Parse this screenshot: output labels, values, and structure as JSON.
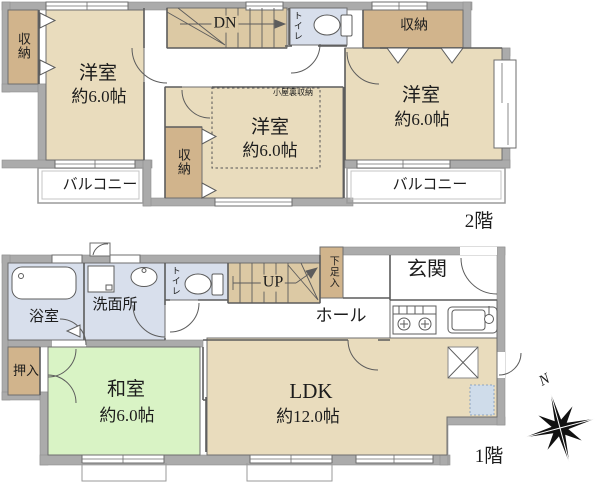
{
  "floor2": {
    "floor_label": "2階",
    "closet_tl": "収納",
    "bedroom_left": {
      "name": "洋室",
      "size": "約6.0帖"
    },
    "stairs_label": "DN",
    "toilet_label": "トイレ",
    "closet_tr": "収納",
    "bedroom_right": {
      "name": "洋室",
      "size": "約6.0帖"
    },
    "attic_label": "小屋裏収納",
    "bedroom_center": {
      "name": "洋室",
      "size": "約6.0帖"
    },
    "closet_center": "収納",
    "balcony_left": "バルコニー",
    "balcony_right": "バルコニー"
  },
  "floor1": {
    "floor_label": "1階",
    "bath": "浴室",
    "washroom": "洗面所",
    "toilet_label": "トイレ",
    "stairs_label": "UP",
    "shoe_cabinet": "下足入",
    "entrance": "玄関",
    "hall": "ホール",
    "closet": "押入",
    "japanese_room": {
      "name": "和室",
      "size": "約6.0帖"
    },
    "ldk": {
      "name": "LDK",
      "size": "約12.0帖"
    }
  },
  "compass": {
    "north": "N"
  },
  "colors": {
    "room_tan": "#e9dcbd",
    "closet_tan": "#d1b48c",
    "stair_tan": "#dcc9a4",
    "wet_blue": "#d8dfec",
    "tatami_green": "#d9f3c5",
    "wall_gray": "#ababab",
    "under_floor_blue": "#cfdcea"
  }
}
